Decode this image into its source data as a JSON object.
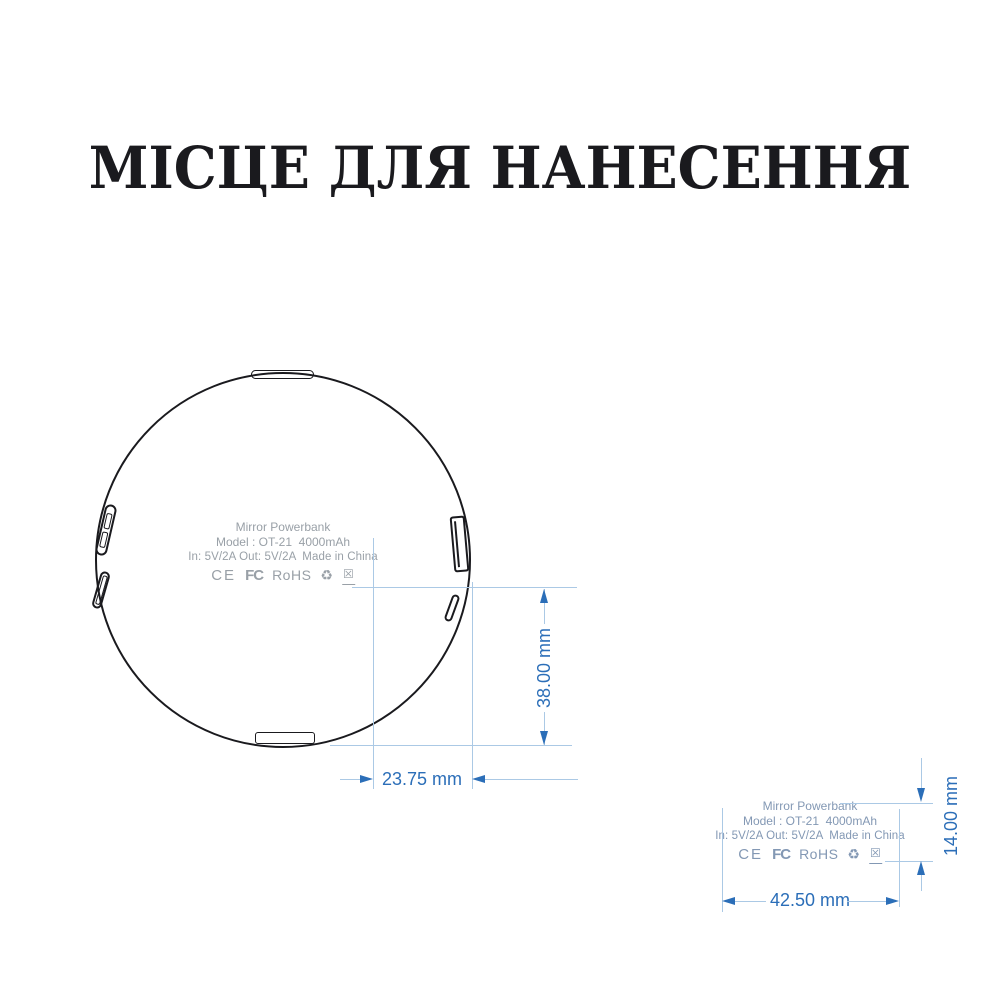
{
  "title": "МІСЦЕ ДЛЯ НАНЕСЕННЯ",
  "product_label": {
    "name": "Mirror Powerbank",
    "model_line": "Model : OT-21  4000mAh",
    "power_line": "In: 5V/2A Out: 5V/2A  Made in China",
    "certifications": {
      "ce": "CE",
      "fcc": "FC",
      "rohs": "RoHS",
      "recycle_icon": "♻",
      "weee_icon": "☒"
    }
  },
  "dimensions": {
    "circle_print_width": "23.75 mm",
    "circle_print_height": "38.00 mm",
    "label_width": "42.50 mm",
    "label_height": "14.00 mm"
  },
  "colors": {
    "accent_blue": "#2b6eb8",
    "pale_blue": "#abc9e5",
    "label_gray": "#99a0a7",
    "label_blue_gray": "#8398b4",
    "ink": "#1a1a1e"
  }
}
